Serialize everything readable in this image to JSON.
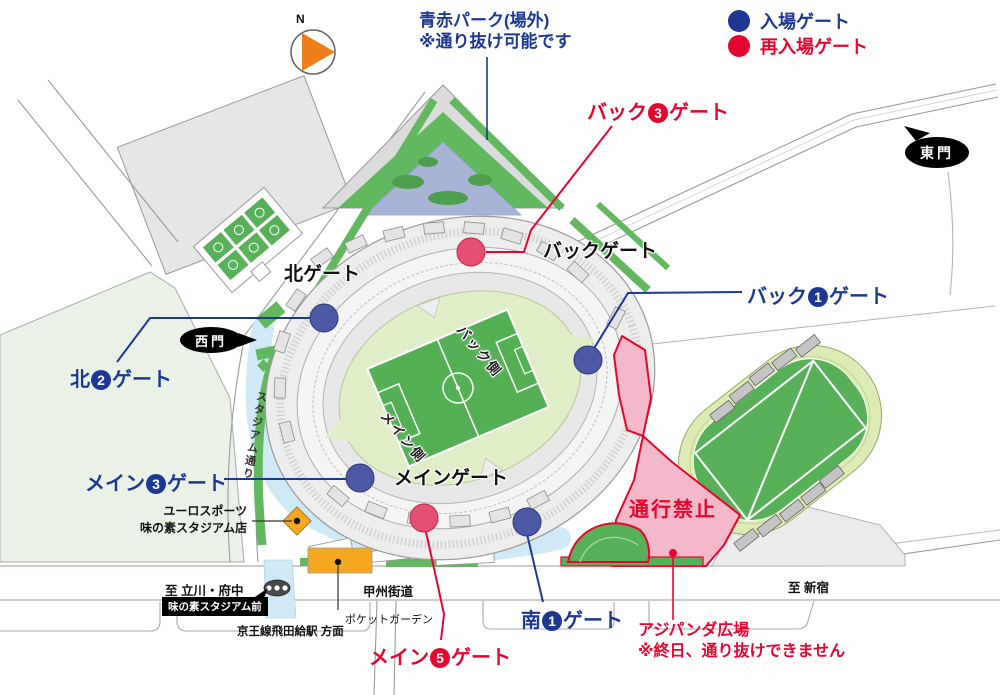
{
  "compass": {
    "north_label": "N"
  },
  "legend": {
    "entry": {
      "label": "入場ゲート",
      "color": "#1d3893"
    },
    "reentry": {
      "label": "再入場ゲート",
      "color": "#e5062f"
    }
  },
  "park_label": {
    "line1": "青赤パーク(場外)",
    "line2": "※通り抜け可能です"
  },
  "gate_labels": {
    "back3": {
      "prefix": "バック",
      "number": "3",
      "suffix": "ゲート"
    },
    "back_gate": {
      "label": "バックゲート"
    },
    "north_gate": {
      "label": "北ゲート"
    },
    "back1": {
      "prefix": "バック",
      "number": "1",
      "suffix": "ゲート"
    },
    "north2": {
      "prefix": "北",
      "number": "2",
      "suffix": "ゲート"
    },
    "main3": {
      "prefix": "メイン",
      "number": "3",
      "suffix": "ゲート"
    },
    "main_gate": {
      "label": "メインゲート"
    },
    "south1": {
      "prefix": "南",
      "number": "1",
      "suffix": "ゲート"
    },
    "main5": {
      "prefix": "メイン",
      "number": "5",
      "suffix": "ゲート"
    }
  },
  "doors": {
    "east": "東門",
    "west": "西門"
  },
  "zones": {
    "no_entry": "通行禁止",
    "ajipanda": {
      "line1": "アジパンダ広場",
      "line2": "※終日、通り抜けできません"
    },
    "pocket_garden": "ポケットガーデン",
    "euro_sports": {
      "line1": "ユーロスポーツ",
      "line2": "味の素スタジアム店"
    }
  },
  "stadium": {
    "back_side": "バック側",
    "main_side": "メイン側"
  },
  "roads": {
    "stadium_street": "スタジアム通り",
    "koshu_kaido": "甲州街道",
    "to_tachikawa": "至 立川・府中",
    "to_shinjuku": "至 新宿"
  },
  "transit": {
    "bus_stop": "味の素スタジアム前",
    "station_direction": "京王線飛田給駅 方面"
  },
  "colors": {
    "entry_blue": "#1d3893",
    "reentry_red": "#e5062f"
  }
}
